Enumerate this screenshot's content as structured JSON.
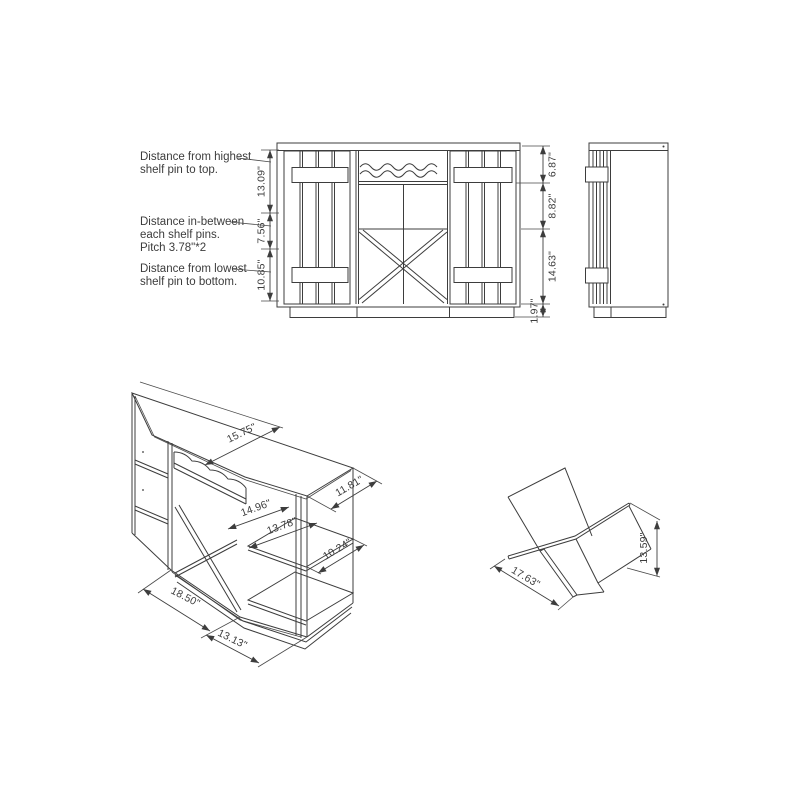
{
  "page": {
    "background": "#ffffff",
    "line_color": "#3d3d3d"
  },
  "notes": {
    "highest": {
      "line1": "Distance from highest",
      "line2": "shelf pin to top."
    },
    "between": {
      "line1": "Distance in-between",
      "line2": "each shelf pins.",
      "line3": "Pitch 3.78\"*2"
    },
    "lowest": {
      "line1": "Distance from lowest",
      "line2": "shelf pin to bottom."
    }
  },
  "front_view": {
    "left_dims": {
      "d1": "13.09\"",
      "d2": "7.56\"",
      "d3": "10.85\""
    },
    "right_dims": {
      "d1": "6.87\"",
      "d2": "8.82\"",
      "d3": "14.63\"",
      "d4": "1.97\""
    }
  },
  "iso_view": {
    "dims": {
      "top_depth": "15.75\"",
      "side_depth": "11.81\"",
      "opening_width": "14.96\"",
      "shelf_width": "13.78\"",
      "shelf_depth": "10.24\"",
      "bottom_left_edge": "18.50\"",
      "bottom_front_edge": "13.13\""
    }
  },
  "cross_view": {
    "dims": {
      "width": "17.63\"",
      "height": "13.59\""
    }
  }
}
